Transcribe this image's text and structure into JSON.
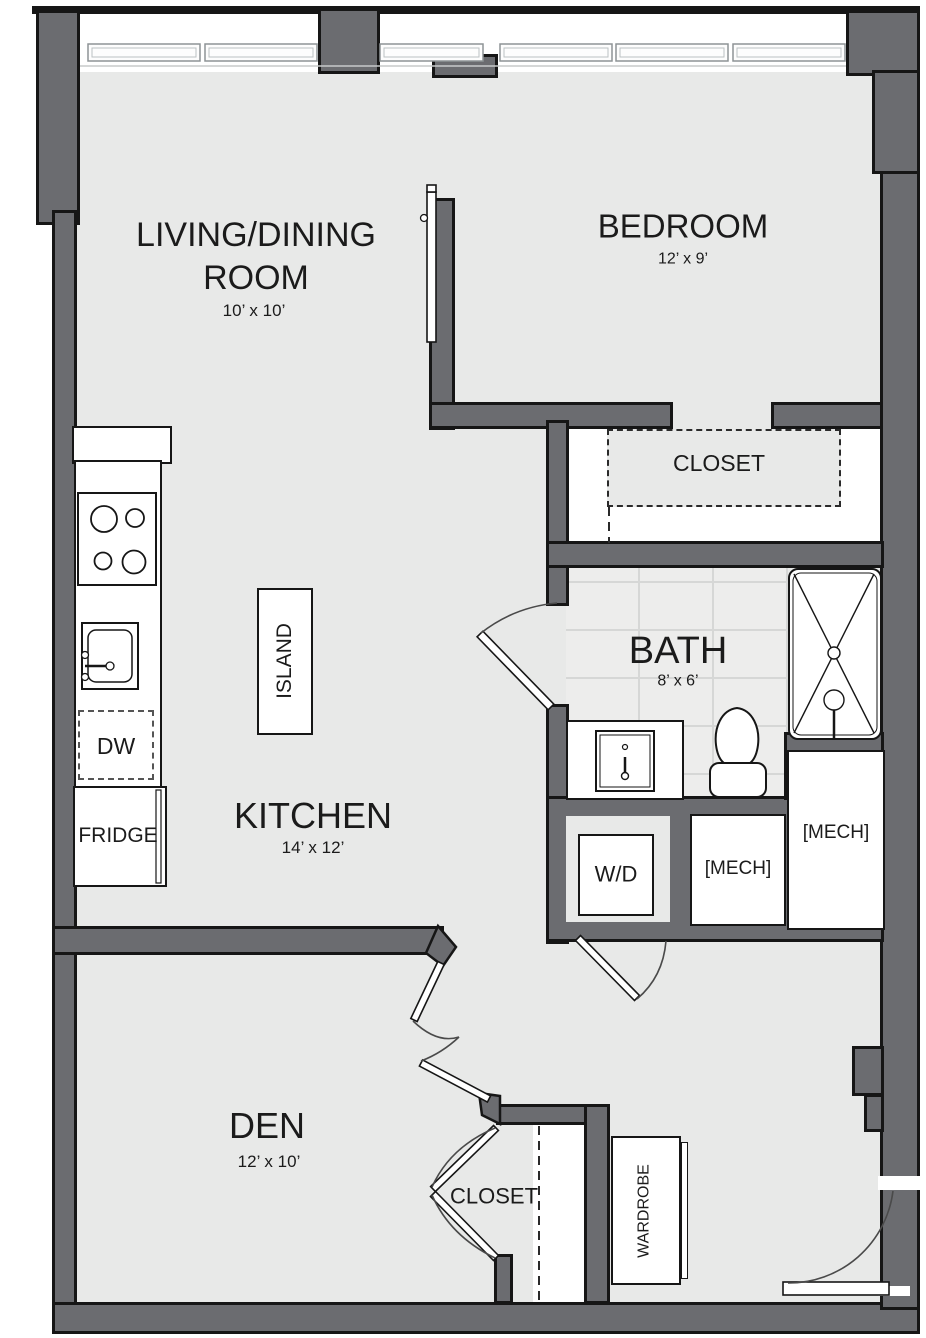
{
  "plan_title": "Apartment floor plan",
  "colors": {
    "wall": "#6b6c70",
    "outline": "#161616",
    "floor": "#e8e9e8",
    "tile": "#ededec",
    "white": "#ffffff"
  },
  "rooms": {
    "living": {
      "line1": "LIVING/DINING",
      "line2": "ROOM",
      "dims": "10’ x 10’"
    },
    "bedroom": {
      "name": "BEDROOM",
      "dims": "12’ x 9’"
    },
    "closet_top": {
      "name": "CLOSET"
    },
    "bath": {
      "name": "BATH",
      "dims": "8’ x 6’"
    },
    "kitchen": {
      "name": "KITCHEN",
      "dims": "14’ x 12’"
    },
    "den": {
      "name": "DEN",
      "dims": "12’ x 10’"
    },
    "closet_bottom": {
      "name": "CLOSET"
    }
  },
  "fixtures": {
    "island": "ISLAND",
    "dishwasher": "DW",
    "fridge": "FRIDGE",
    "washer_dryer": "W/D",
    "mech_middle": "[MECH]",
    "mech_right": "[MECH]",
    "wardrobe": "WARDROBE"
  }
}
